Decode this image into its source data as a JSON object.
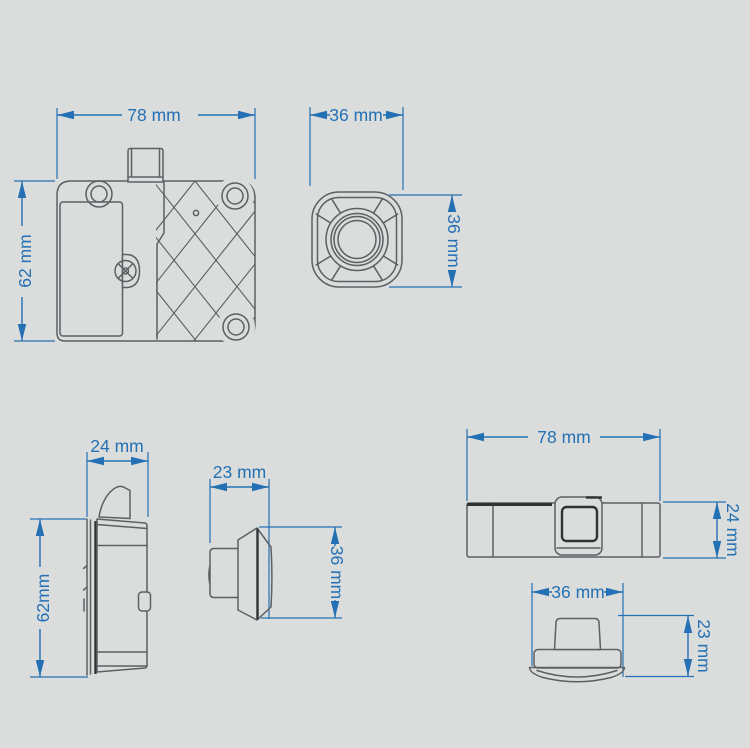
{
  "colors": {
    "background": "#dbdcdc",
    "line": "#5c6063",
    "line_dark": "#2f3335",
    "dim": "#2371b4"
  },
  "views": {
    "lock_front": {
      "width_label": "78 mm",
      "height_label": "62 mm"
    },
    "sensor_front": {
      "width_label": "36 mm",
      "height_label": "36 mm"
    },
    "lock_side": {
      "width_label": "24 mm",
      "height_label": "62mm"
    },
    "sensor_side": {
      "width_label": "23 mm",
      "height_label": "36 mm"
    },
    "lock_top": {
      "width_label": "78 mm",
      "depth_label": "24 mm"
    },
    "sensor_top": {
      "width_label": "36 mm",
      "depth_label": "23 mm"
    }
  }
}
